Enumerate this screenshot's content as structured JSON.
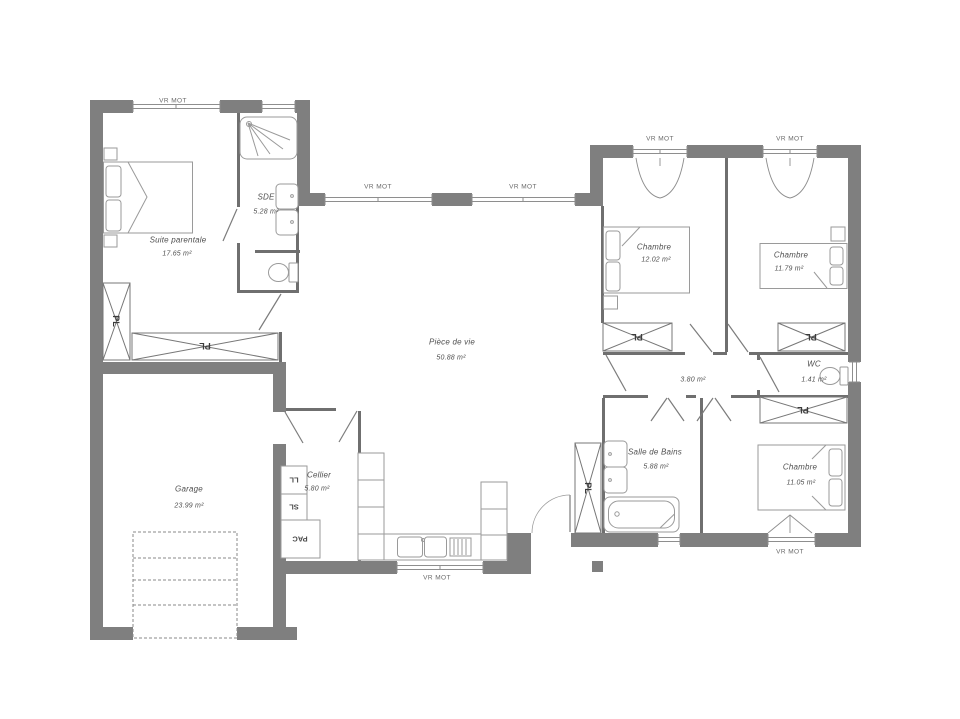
{
  "plan": {
    "labels": {
      "window": "VR MOT",
      "closet": "PL",
      "washing_machine": "LL",
      "dryer": "SL",
      "heat_pump": "PAC"
    },
    "rooms": {
      "suite_parentale": {
        "name": "Suite parentale",
        "area": "17.65 m²"
      },
      "sde": {
        "name": "SDE",
        "area": "5.28 m²"
      },
      "piece_de_vie": {
        "name": "Pièce de vie",
        "area": "50.88 m²"
      },
      "garage": {
        "name": "Garage",
        "area": "23.99 m²"
      },
      "cellier": {
        "name": "Cellier",
        "area": "5.80 m²"
      },
      "chambre_1": {
        "name": "Chambre",
        "area": "12.02 m²"
      },
      "chambre_2": {
        "name": "Chambre",
        "area": "11.79 m²"
      },
      "chambre_3": {
        "name": "Chambre",
        "area": "11.05 m²"
      },
      "salle_de_bains": {
        "name": "Salle de Bains",
        "area": "5.88 m²"
      },
      "wc": {
        "name": "WC",
        "area": "1.41 m²"
      },
      "degagement": {
        "area": "3.80 m²"
      }
    },
    "colors": {
      "wall": "#7f7f7f",
      "fixture_line": "#9a9a9a",
      "text": "#4f4f4f"
    }
  }
}
